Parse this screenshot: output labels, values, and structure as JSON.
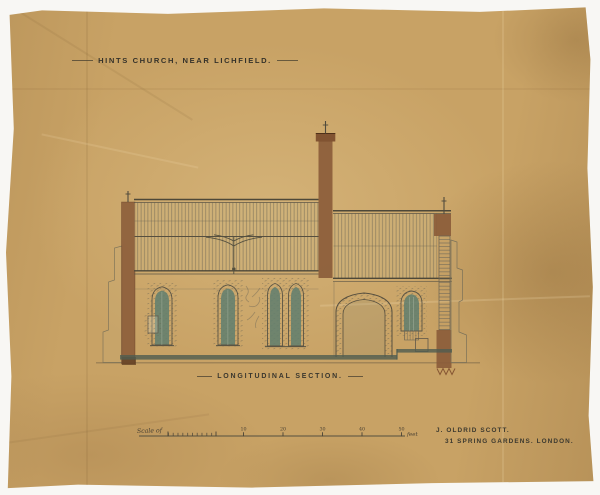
{
  "document": {
    "title": "HINTS CHURCH, NEAR LICHFIELD.",
    "caption": "LONGITUDINAL SECTION.",
    "architect": {
      "name": "J. OLDRID SCOTT.",
      "address": "31 SPRING GARDENS. LONDON."
    },
    "scale_bar": {
      "label": "Scale of",
      "unit": "feet",
      "ticks": [
        "10",
        "20",
        "30",
        "40",
        "50"
      ]
    }
  },
  "drawing": {
    "subject": "longitudinal-section-of-church",
    "parts": [
      "west-wall",
      "nave-roof",
      "roof-truss",
      "nave-windows",
      "bellcote",
      "chancel-roof",
      "chancel-arch",
      "chancel-window",
      "east-wall",
      "floor-line",
      "ground-line",
      "scale-bar",
      "pencil-annotation"
    ]
  },
  "colors": {
    "paper": "#c8a265",
    "ink": "#4a4436",
    "masonry_wash": "#8a5b39",
    "glazing_wash": "#5f7e6e",
    "roof_wash": "#d0b67f",
    "floor_wash": "#4f5d50"
  }
}
